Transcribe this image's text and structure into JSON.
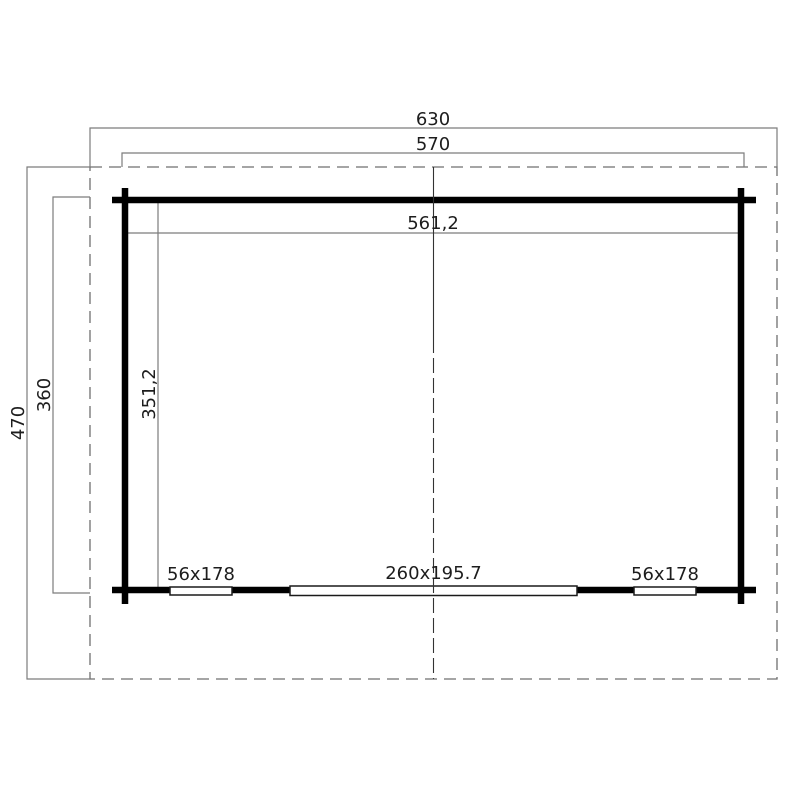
{
  "drawing": {
    "type": "floor-plan",
    "labels": {
      "roof_width": "630",
      "outer_width": "570",
      "inner_width": "561,2",
      "roof_depth": "470",
      "outer_depth": "360",
      "inner_depth": "351,2",
      "left_window": "56x178",
      "door": "260x195.7",
      "right_window": "56x178"
    },
    "dimensions": {
      "roof": {
        "width_cm": 630,
        "depth_cm": 470
      },
      "walls_outer": {
        "width_cm": 570,
        "depth_cm": 360
      },
      "interior": {
        "width_cm": 561.2,
        "depth_cm": 351.2
      },
      "windows_cm": "56x178",
      "door_cm": "260x195.7"
    }
  },
  "colors": {
    "wall": "#000000",
    "dim": "#7c7c7c",
    "roofdash": "#6f6f6f",
    "centerline": "#333333",
    "openingborder": "#1a1a1a",
    "textcolor": "#1d1d1d",
    "background": "#ffffff"
  }
}
